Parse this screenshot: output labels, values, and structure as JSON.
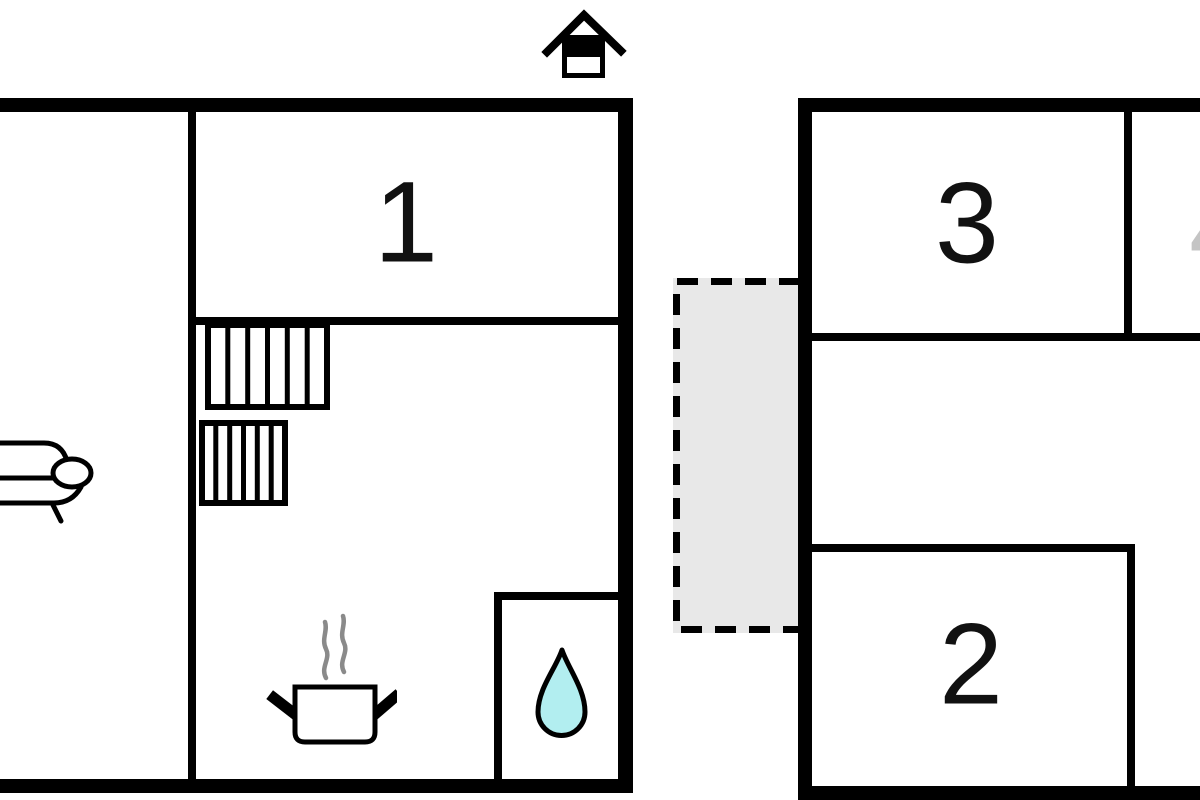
{
  "diagram": {
    "type": "floor-plan",
    "buildings": 2
  },
  "rooms": [
    {
      "id": "room-1",
      "label": "1"
    },
    {
      "id": "room-2",
      "label": "2"
    },
    {
      "id": "room-3",
      "label": "3"
    },
    {
      "id": "room-4-partial",
      "label": "4"
    }
  ],
  "icons": {
    "entrance": "house-icon",
    "living_area": "sofa-icon",
    "stairs": "stairs-icon",
    "kitchen": "cooking-pot-with-steam-icon",
    "bathroom": "water-drop-icon",
    "terrace": "dashed-outline-area"
  },
  "stairs": {
    "upper_flight_treads": 6,
    "lower_flight_treads": 6
  },
  "colors": {
    "wall": "#000000",
    "background": "#ffffff",
    "water_drop_fill": "#b2eef0",
    "steam_gray": "#8a8a8a",
    "terrace_fill": "#e8e8e8",
    "partial_label_gray": "#c4c4c4"
  }
}
